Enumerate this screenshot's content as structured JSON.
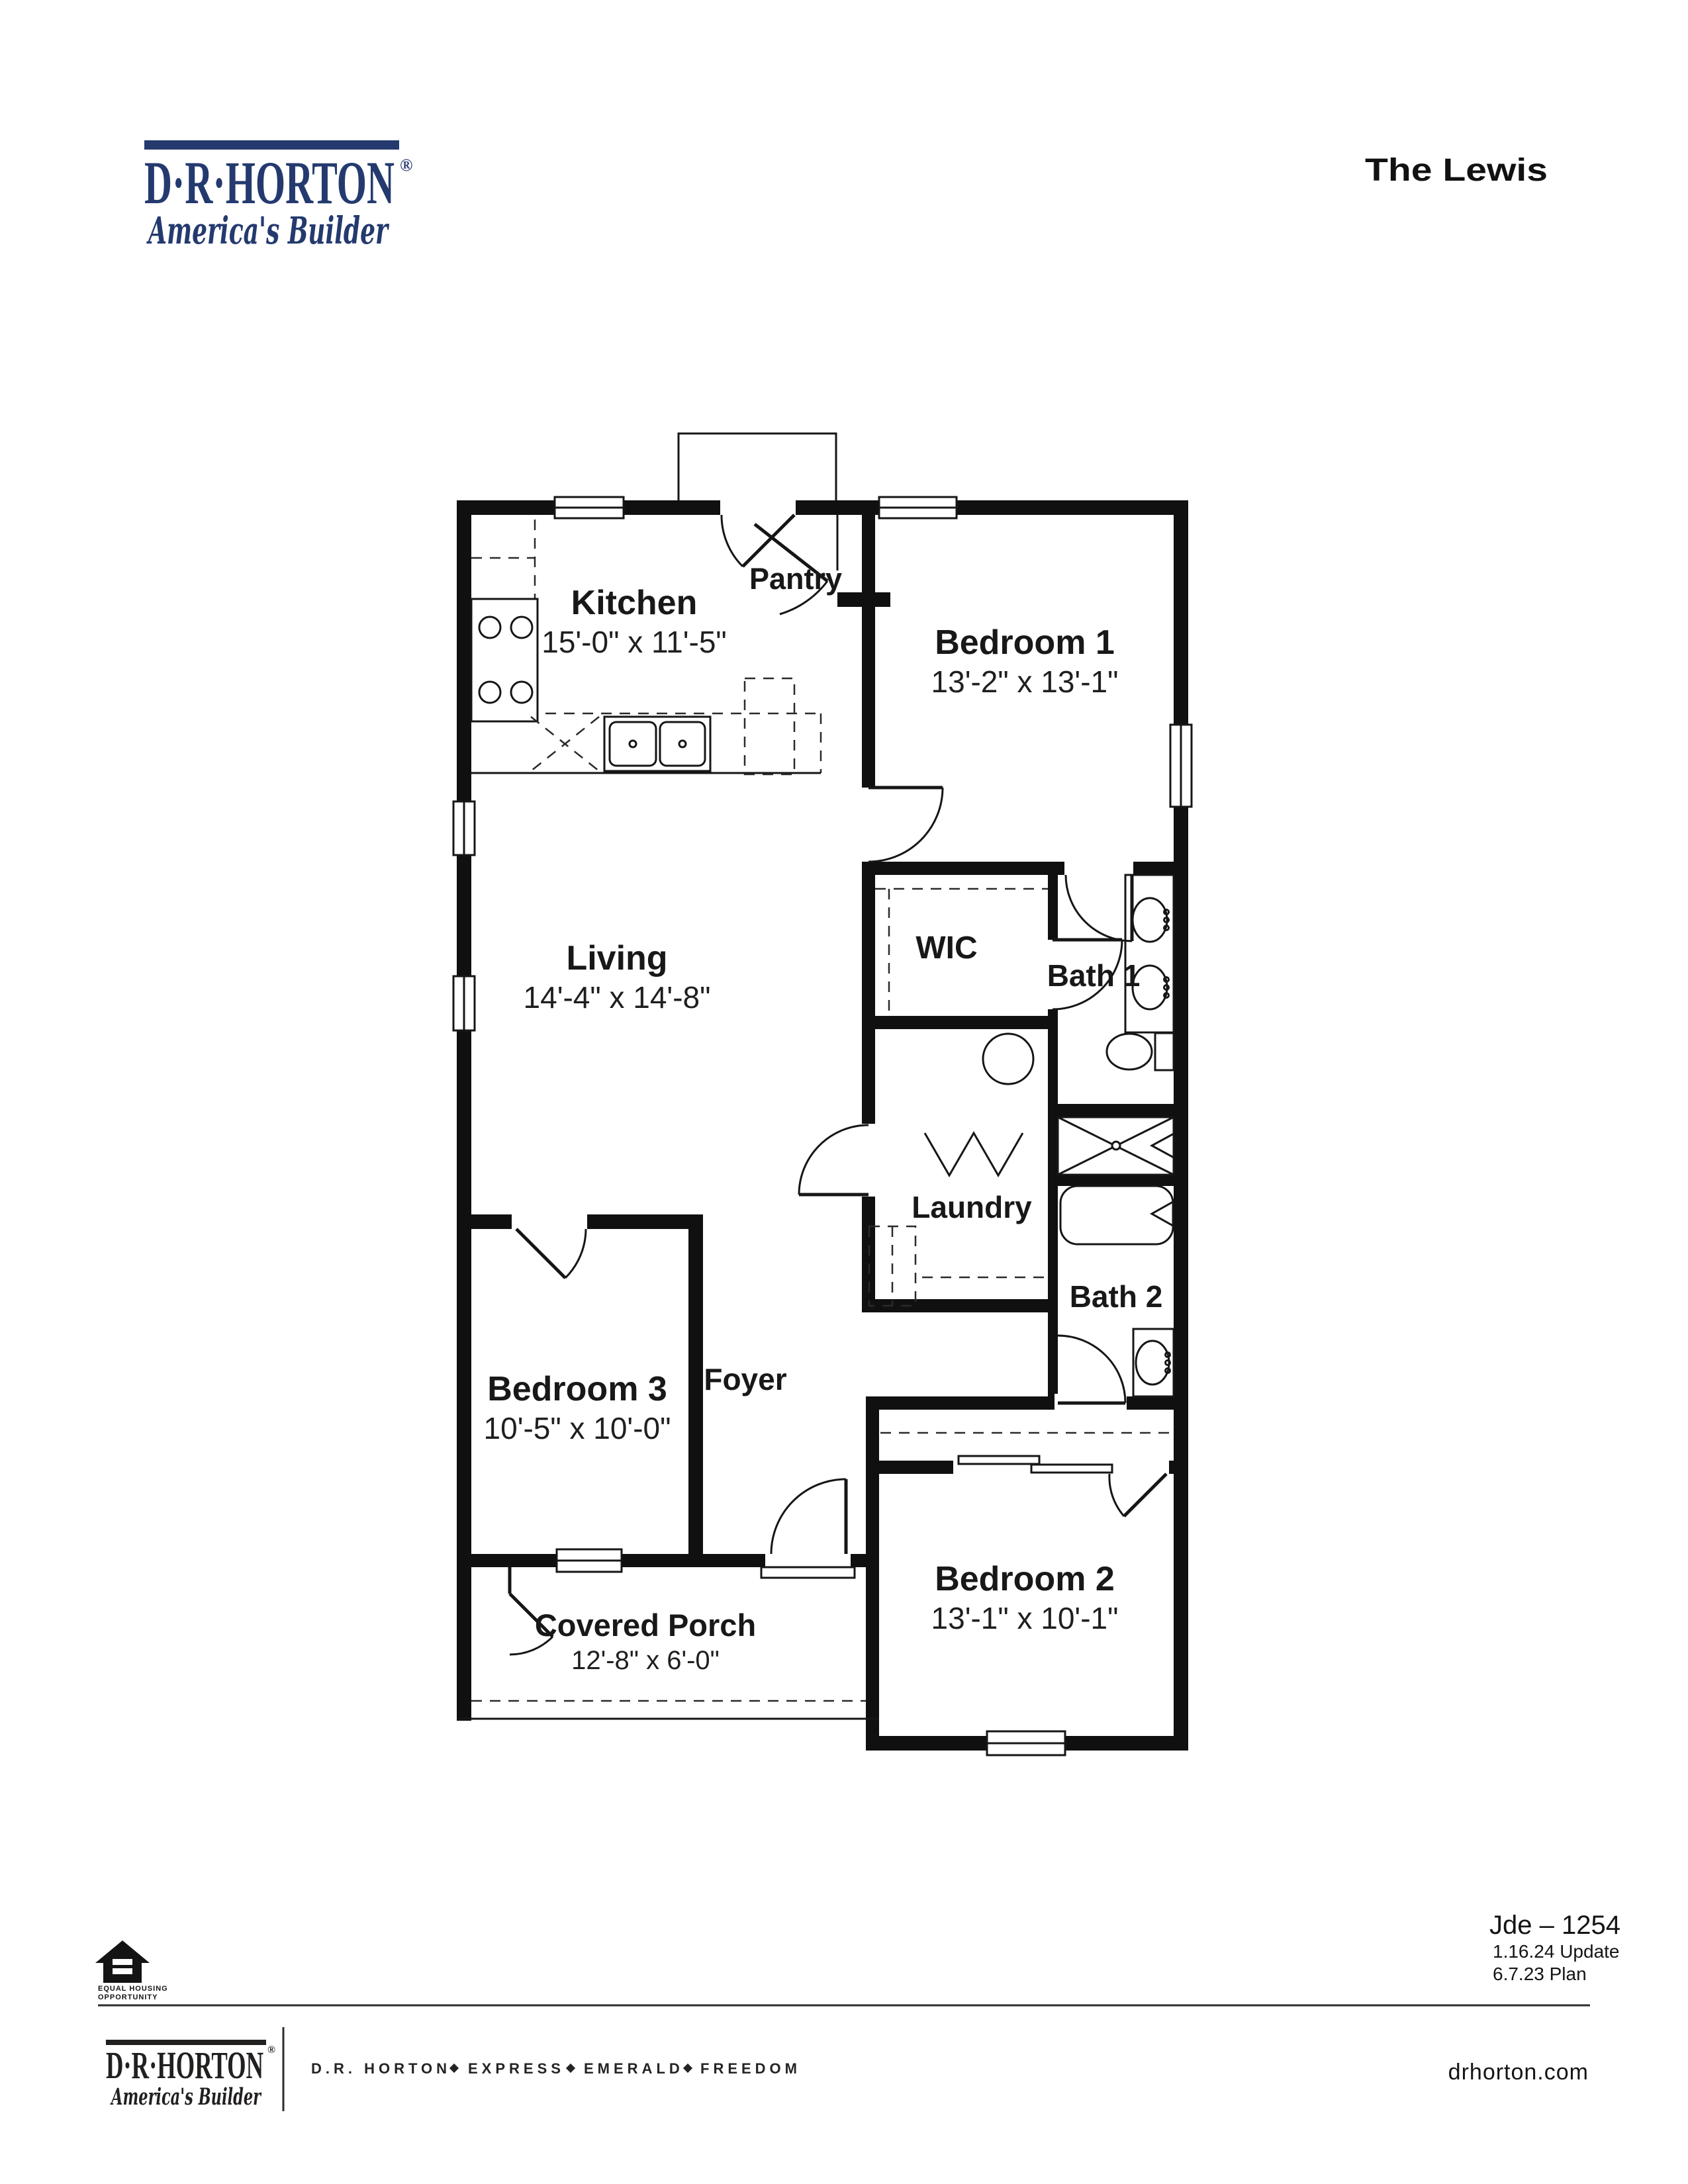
{
  "brand": {
    "name": "D·R·HORTON",
    "registered": "®",
    "tagline": "America's Builder"
  },
  "plan": {
    "title": "The Lewis"
  },
  "rooms": {
    "kitchen": {
      "name": "Kitchen",
      "dims": "15'-0\" x 11'-5\""
    },
    "pantry": {
      "name": "Pantry"
    },
    "bedroom1": {
      "name": "Bedroom 1",
      "dims": "13'-2\" x 13'-1\""
    },
    "living": {
      "name": "Living",
      "dims": "14'-4\" x 14'-8\""
    },
    "wic": {
      "name": "WIC"
    },
    "bath1": {
      "name": "Bath 1"
    },
    "laundry": {
      "name": "Laundry"
    },
    "bath2": {
      "name": "Bath 2"
    },
    "bedroom3": {
      "name": "Bedroom 3",
      "dims": "10'-5\" x 10'-0\""
    },
    "foyer": {
      "name": "Foyer"
    },
    "bedroom2": {
      "name": "Bedroom 2",
      "dims": "13'-1\" x 10'-1\""
    },
    "covered_porch": {
      "name": "Covered Porch",
      "dims": "12'-8\" x 6'-0\""
    }
  },
  "plan_info": {
    "id": "Jde – 1254",
    "update": "1.16.24 Update",
    "plan": "6.7.23 Plan"
  },
  "footer": {
    "brand": {
      "name": "D·R·HORTON",
      "registered": "®",
      "tagline": "America's Builder"
    },
    "series": [
      "D.R. HORTON",
      "EXPRESS",
      "EMERALD",
      "FREEDOM"
    ],
    "website": "drhorton.com"
  },
  "legal": {
    "line1": "EQUAL HOUSING",
    "line2": "OPPORTUNITY"
  },
  "colors": {
    "brand_navy": "#243A6F",
    "footer_ink": "#221F1F",
    "plan_ink": "#101010"
  }
}
